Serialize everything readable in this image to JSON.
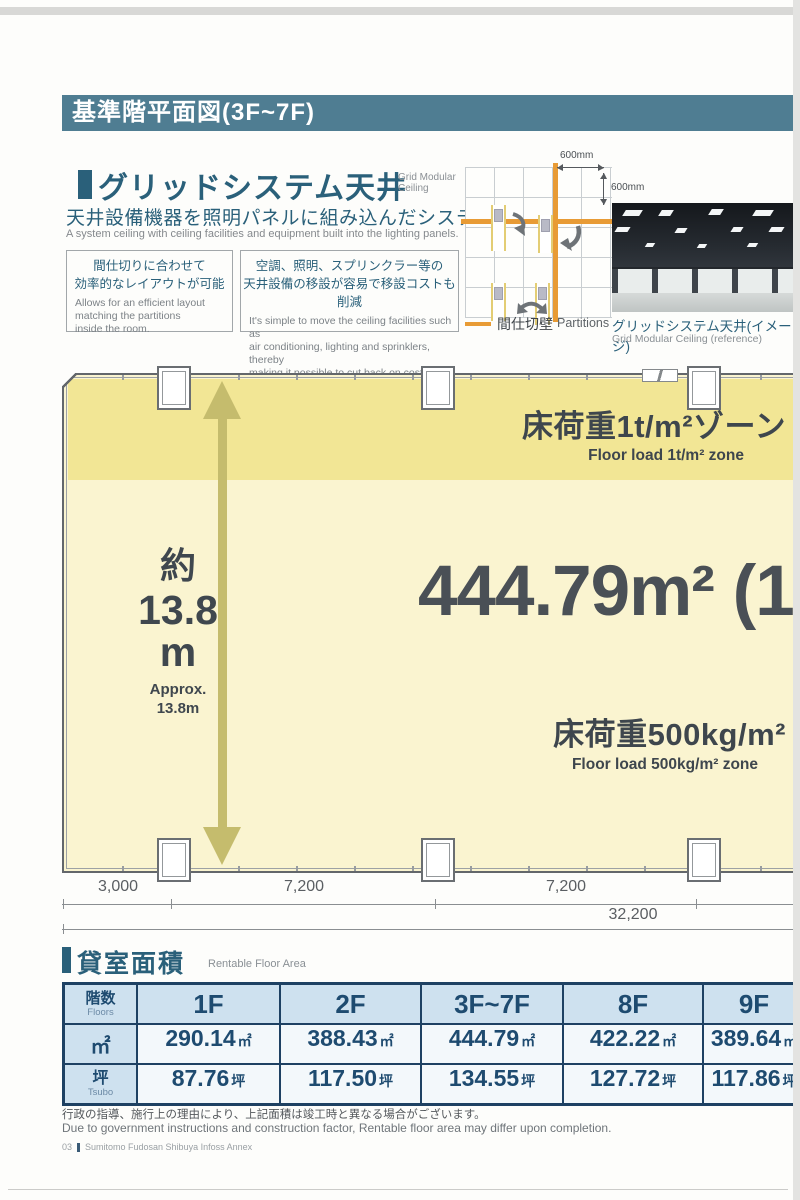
{
  "header": {
    "title": "基準階平面図(3F~7F)"
  },
  "ceiling_section": {
    "title_jp": "グリッドシステム天井",
    "title_en_line1": "Grid Modular",
    "title_en_line2": "Ceiling",
    "subtitle_jp": "天井設備機器を照明パネルに組み込んだシステム天井。",
    "subtitle_en": "A system ceiling with ceiling facilities and equipment built into the lighting panels.",
    "boxes": [
      {
        "jp": "間仕切りに合わせて\n効率的なレイアウトが可能",
        "en": "Allows for an efficient layout\nmatching the partitions\ninside the room."
      },
      {
        "jp": "空調、照明、スプリンクラー等の\n天井設備の移設が容易で移設コストも削減",
        "en": "It's simple to move the ceiling facilities such as\nair conditioning, lighting and sprinklers, thereby\nmaking it possible to cut back on costs."
      }
    ],
    "diagram": {
      "dim_horizontal": "600mm",
      "dim_vertical": "600mm",
      "legend_jp": "間仕切壁",
      "legend_en": "Partitions",
      "partition_color": "#E89B35"
    },
    "photo": {
      "caption_jp": "グリッドシステム天井(イメージ)",
      "caption_en": "Grid Modular Ceiling (reference)"
    }
  },
  "floor_plan": {
    "zone_1t": {
      "jp": "床荷重1t/m²ゾーン",
      "en": "Floor load 1t/m² zone"
    },
    "area_label": "444.79m² (1",
    "zone_500kg": {
      "jp": "床荷重500kg/m²",
      "en": "Floor load 500kg/m² zone"
    },
    "depth": {
      "jp": "約",
      "value": "13.8",
      "unit": "m",
      "en_line1": "Approx.",
      "en_line2": "13.8m"
    },
    "dimensions": {
      "segments": [
        "3,000",
        "7,200",
        "7,200"
      ],
      "total": "32,200"
    },
    "colors": {
      "zone_1t_fill": "#F2E695",
      "zone_500kg_fill": "#FAF4D0",
      "arrow": "#C5BC6D"
    }
  },
  "rentable_area": {
    "title_jp": "貸室面積",
    "title_en": "Rentable Floor Area",
    "header": {
      "floors_jp": "階数",
      "floors_en": "Floors"
    },
    "row_headers": {
      "sqm": "㎡",
      "tsubo_jp": "坪",
      "tsubo_en": "Tsubo"
    },
    "columns": [
      "1F",
      "2F",
      "3F~7F",
      "8F",
      "9F"
    ],
    "sqm_values": [
      {
        "value": "290.14",
        "unit": "㎡"
      },
      {
        "value": "388.43",
        "unit": "㎡"
      },
      {
        "value": "444.79",
        "unit": "㎡"
      },
      {
        "value": "422.22",
        "unit": "㎡"
      },
      {
        "value": "389.64",
        "unit": "㎡"
      }
    ],
    "tsubo_values": [
      {
        "value": "87.76",
        "unit": "坪"
      },
      {
        "value": "117.50",
        "unit": "坪"
      },
      {
        "value": "134.55",
        "unit": "坪"
      },
      {
        "value": "127.72",
        "unit": "坪"
      },
      {
        "value": "117.86",
        "unit": "坪"
      }
    ]
  },
  "footer": {
    "note_jp": "行政の指導、施行上の理由により、上記面積は竣工時と異なる場合がございます。",
    "note_en": "Due to government instructions and construction factor, Rentable floor area may differ upon completion.",
    "page_number": "03",
    "brand": "Sumitomo Fudosan Shibuya Infoss Annex"
  }
}
